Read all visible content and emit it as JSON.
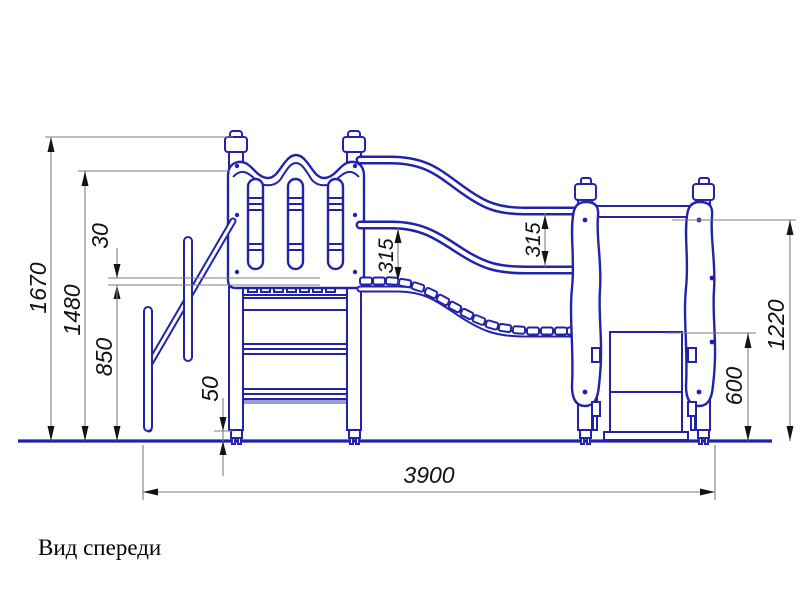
{
  "drawing": {
    "caption": "Вид спереди",
    "line_color": "#2323aa",
    "dim_color": "#7d7d7d",
    "dims": {
      "total_height": "1670",
      "panel_top_height": "1480",
      "platform_height": "850",
      "panel_gap": "30",
      "foot_height": "50",
      "rail_spacing_left": "315",
      "rail_spacing_right": "315",
      "end_frame_height": "1220",
      "slide_exit_height": "600",
      "total_length": "3900"
    }
  }
}
